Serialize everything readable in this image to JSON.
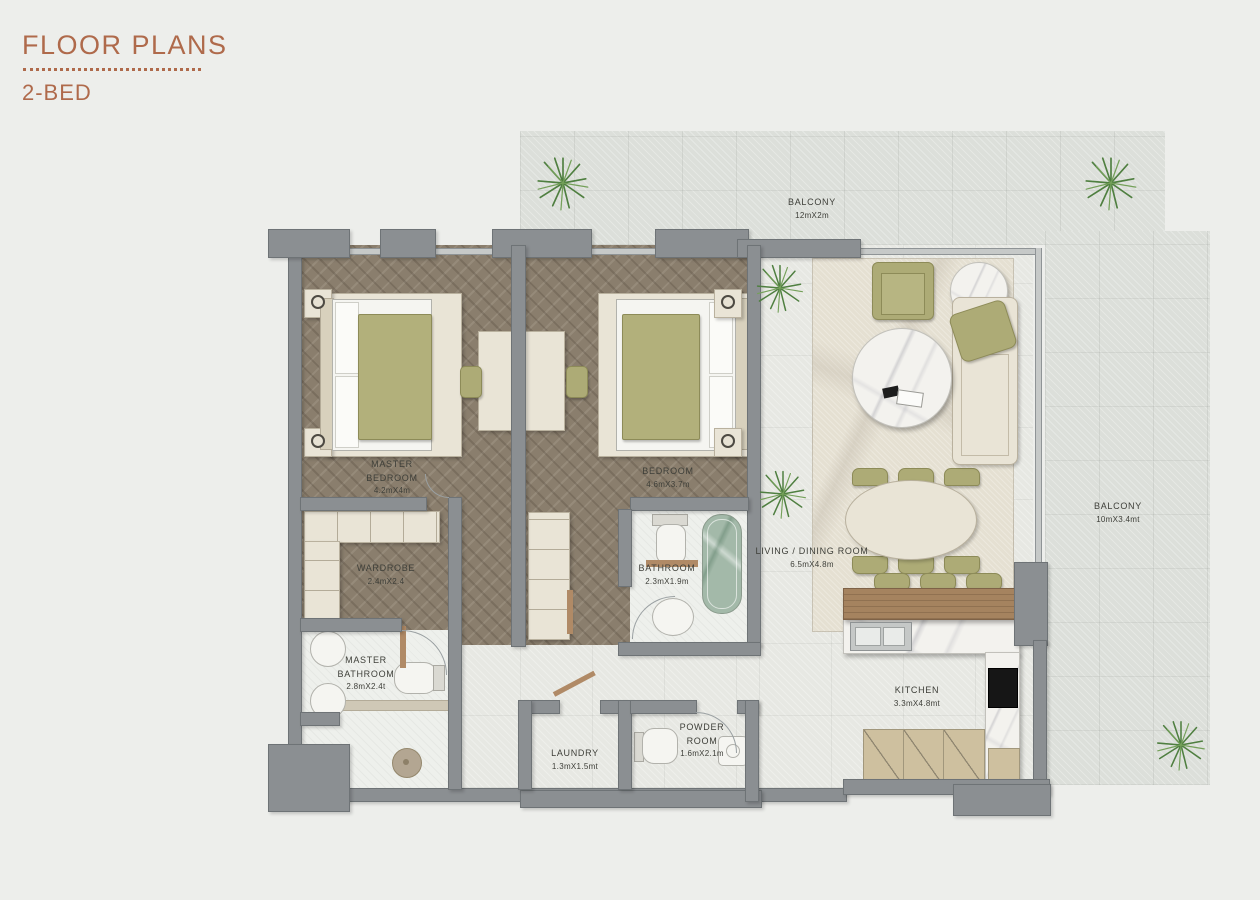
{
  "header": {
    "title": "FLOOR PLANS",
    "subtitle": "2-BED"
  },
  "rooms": {
    "master_bedroom": {
      "name": "MASTER BEDROOM",
      "dims": "4.2mX4m"
    },
    "bedroom": {
      "name": "BEDROOM",
      "dims": "4.6mX3.7m"
    },
    "wardrobe": {
      "name": "WARDROBE",
      "dims": "2.4mX2.4"
    },
    "master_bathroom": {
      "name": "MASTER BATHROOM",
      "dims": "2.8mX2.4t"
    },
    "bathroom": {
      "name": "BATHROOM",
      "dims": "2.3mX1.9m"
    },
    "laundry": {
      "name": "LAUNDRY",
      "dims": "1.3mX1.5mt"
    },
    "powder_room": {
      "name": "POWDER ROOM",
      "dims": "1.6mX2.1m"
    },
    "living_dining": {
      "name": "LIVING / DINING ROOM",
      "dims": "6.5mX4.8m"
    },
    "kitchen": {
      "name": "KITCHEN",
      "dims": "3.3mX4.8mt"
    },
    "balcony_top": {
      "name": "BALCONY",
      "dims": "12mX2m"
    },
    "balcony_right": {
      "name": "BALCONY",
      "dims": "10mX3.4mt"
    }
  },
  "colors": {
    "accent": "#af6a4b",
    "wall": "#8b8f92",
    "wood_floor": "#8a7e6d",
    "tile": "#e7e8e3",
    "balcony_tile": "#dcdfda",
    "olive": "#adab76",
    "cream": "#e9e4d6",
    "label_text": "#3e3f39"
  },
  "icons": {
    "plant": "potted-plant"
  }
}
